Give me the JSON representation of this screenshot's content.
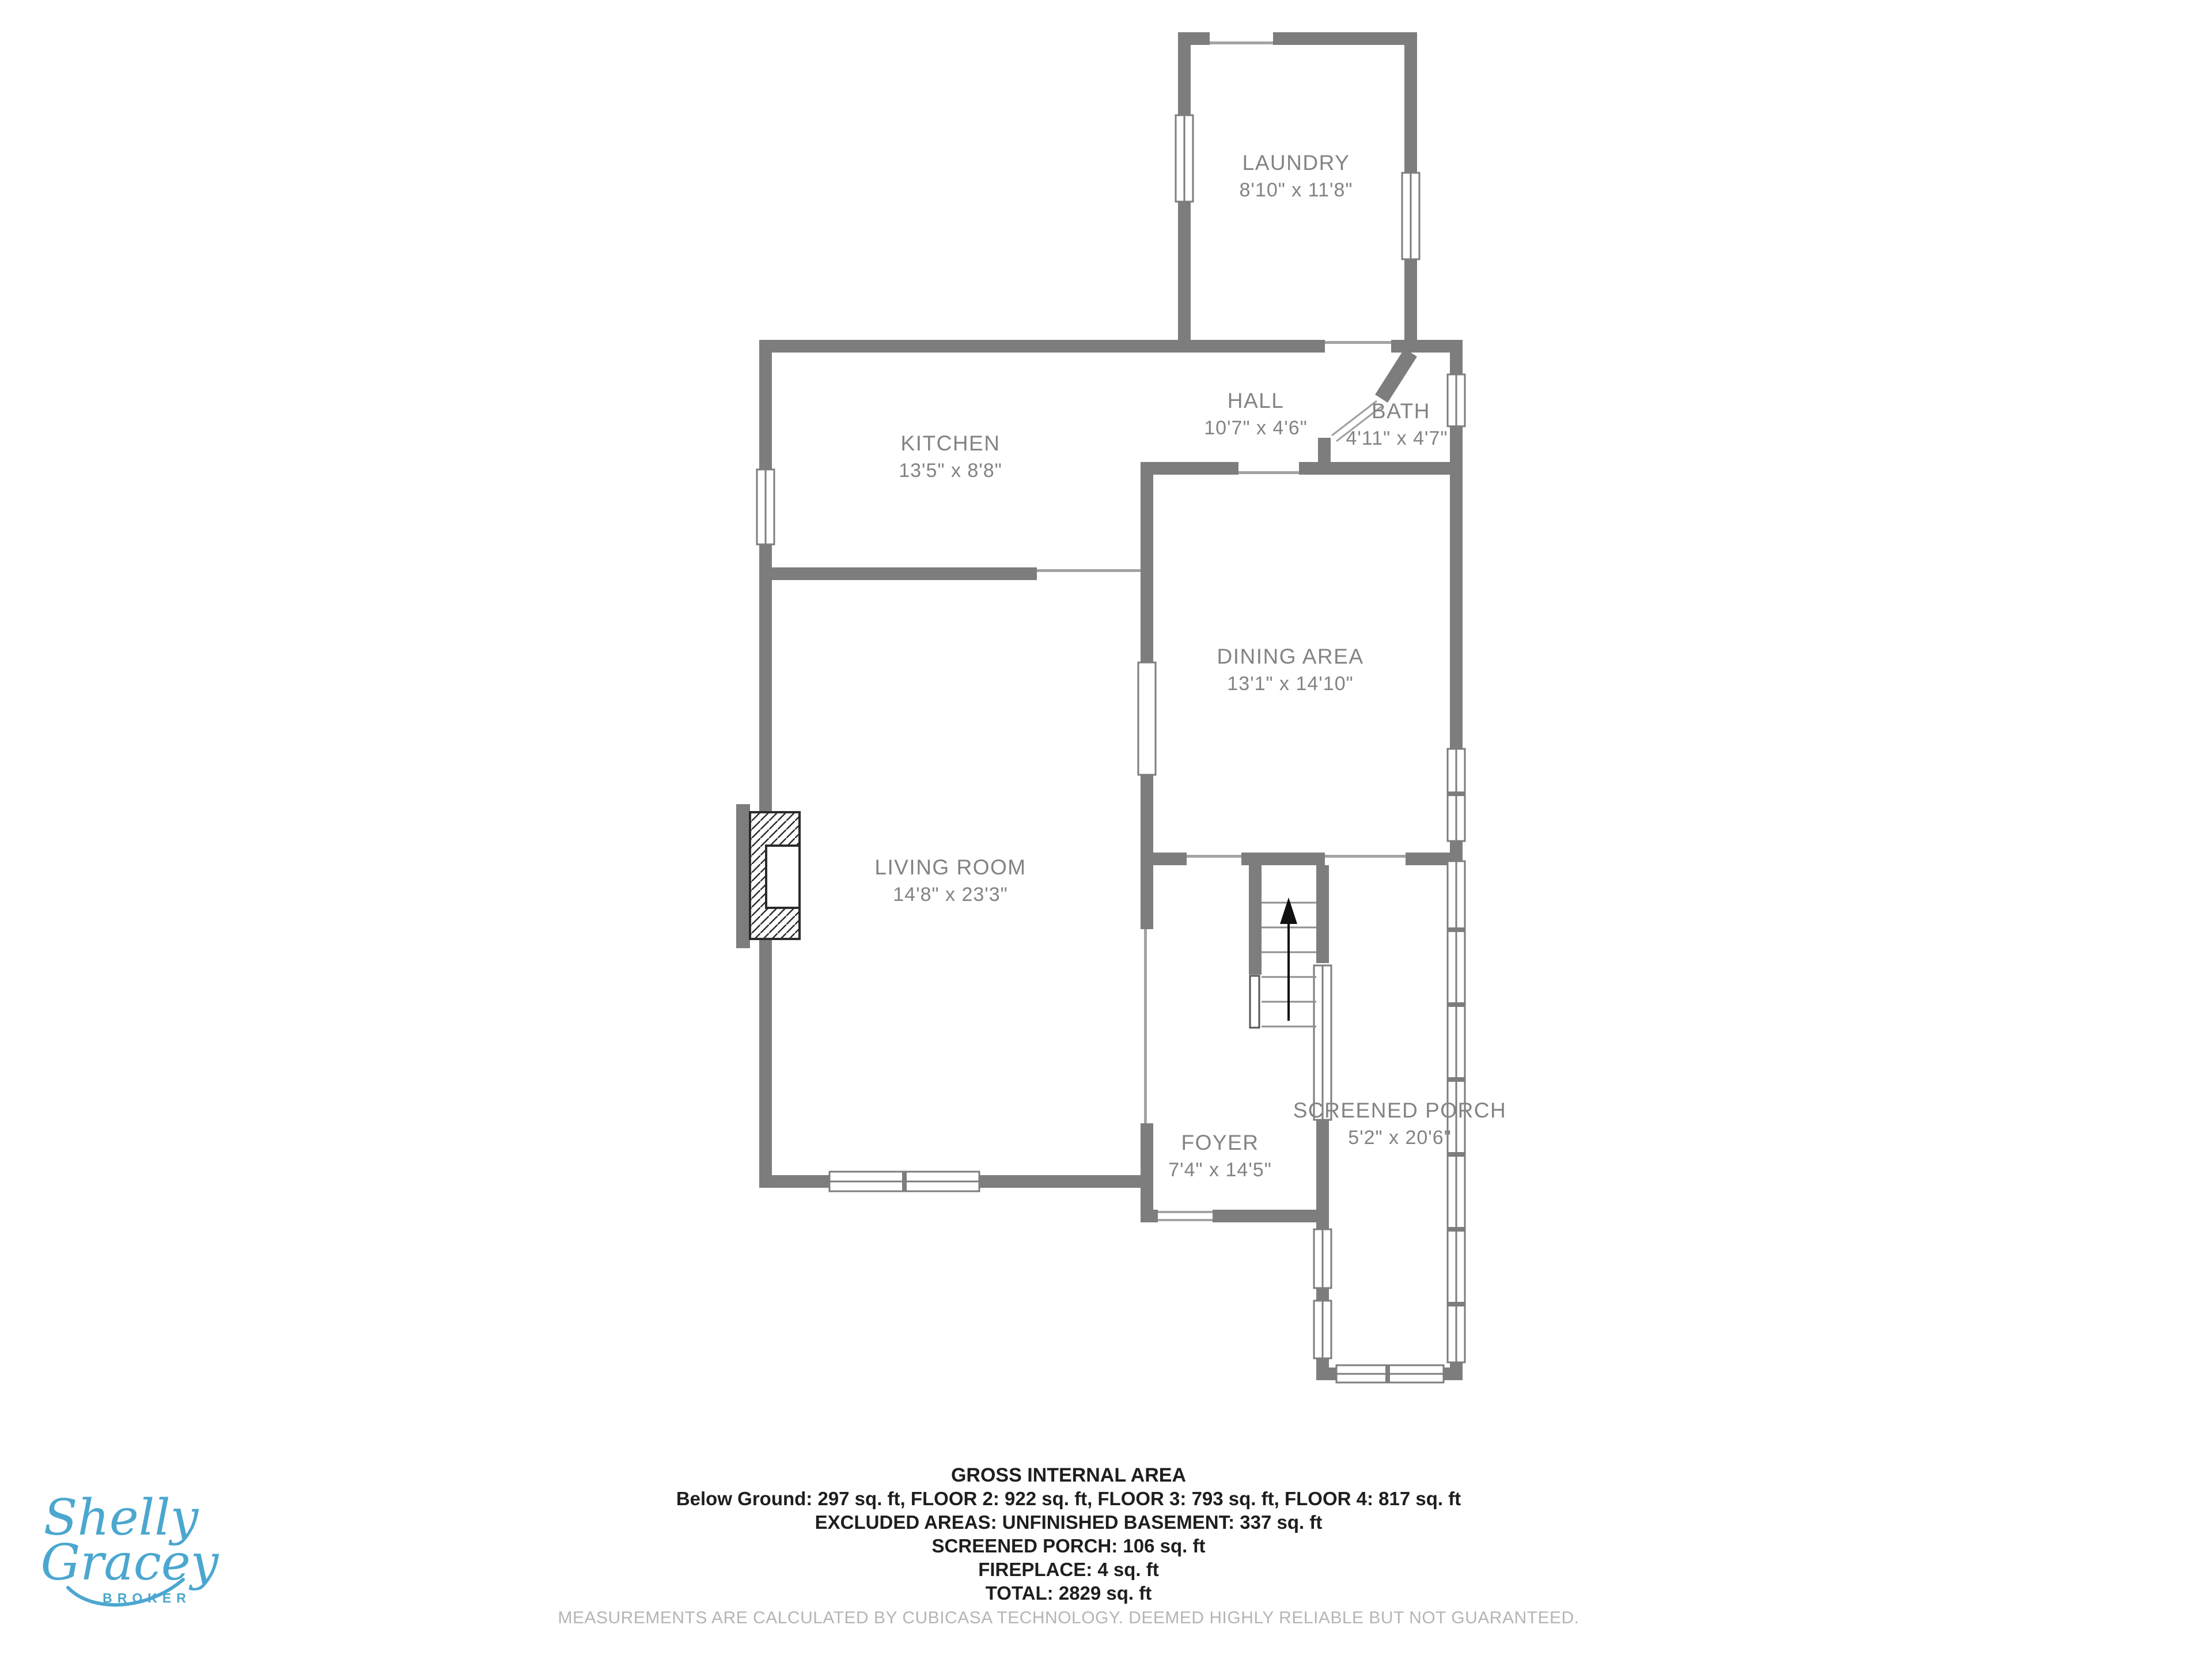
{
  "plan": {
    "rooms": [
      {
        "name": "LAUNDRY",
        "dims": "8'10\" x 11'8\""
      },
      {
        "name": "KITCHEN",
        "dims": "13'5\" x 8'8\""
      },
      {
        "name": "HALL",
        "dims": "10'7\" x 4'6\""
      },
      {
        "name": "BATH",
        "dims": "4'11\" x 4'7\""
      },
      {
        "name": "DINING AREA",
        "dims": "13'1\" x 14'10\""
      },
      {
        "name": "LIVING ROOM",
        "dims": "14'8\" x 23'3\""
      },
      {
        "name": "FOYER",
        "dims": "7'4\" x 14'5\""
      },
      {
        "name": "SCREENED PORCH",
        "dims": "5'2\" x 20'6\""
      }
    ]
  },
  "footer": {
    "title": "GROSS INTERNAL AREA",
    "lines": [
      "Below Ground: 297 sq. ft, FLOOR 2: 922 sq. ft, FLOOR 3: 793 sq. ft, FLOOR 4: 817 sq. ft",
      "EXCLUDED AREAS: UNFINISHED BASEMENT: 337 sq. ft",
      "SCREENED PORCH: 106 sq. ft",
      "FIREPLACE: 4 sq. ft",
      "TOTAL: 2829 sq. ft"
    ],
    "disclaimer": "MEASUREMENTS ARE CALCULATED BY CUBICASA TECHNOLOGY. DEEMED HIGHLY RELIABLE BUT NOT GUARANTEED."
  },
  "logo": {
    "first": "Shelly",
    "last": "Gracey",
    "title": "BROKER"
  },
  "colors": {
    "wall": "#7d7d7d",
    "room_label": "#838383",
    "footer_text": "#1e1e1e",
    "disclaimer": "#b5b5b5",
    "logo_blue": "#4ba7cf",
    "background": "#ffffff"
  },
  "icons": {
    "stairs_direction": "up-arrow"
  }
}
